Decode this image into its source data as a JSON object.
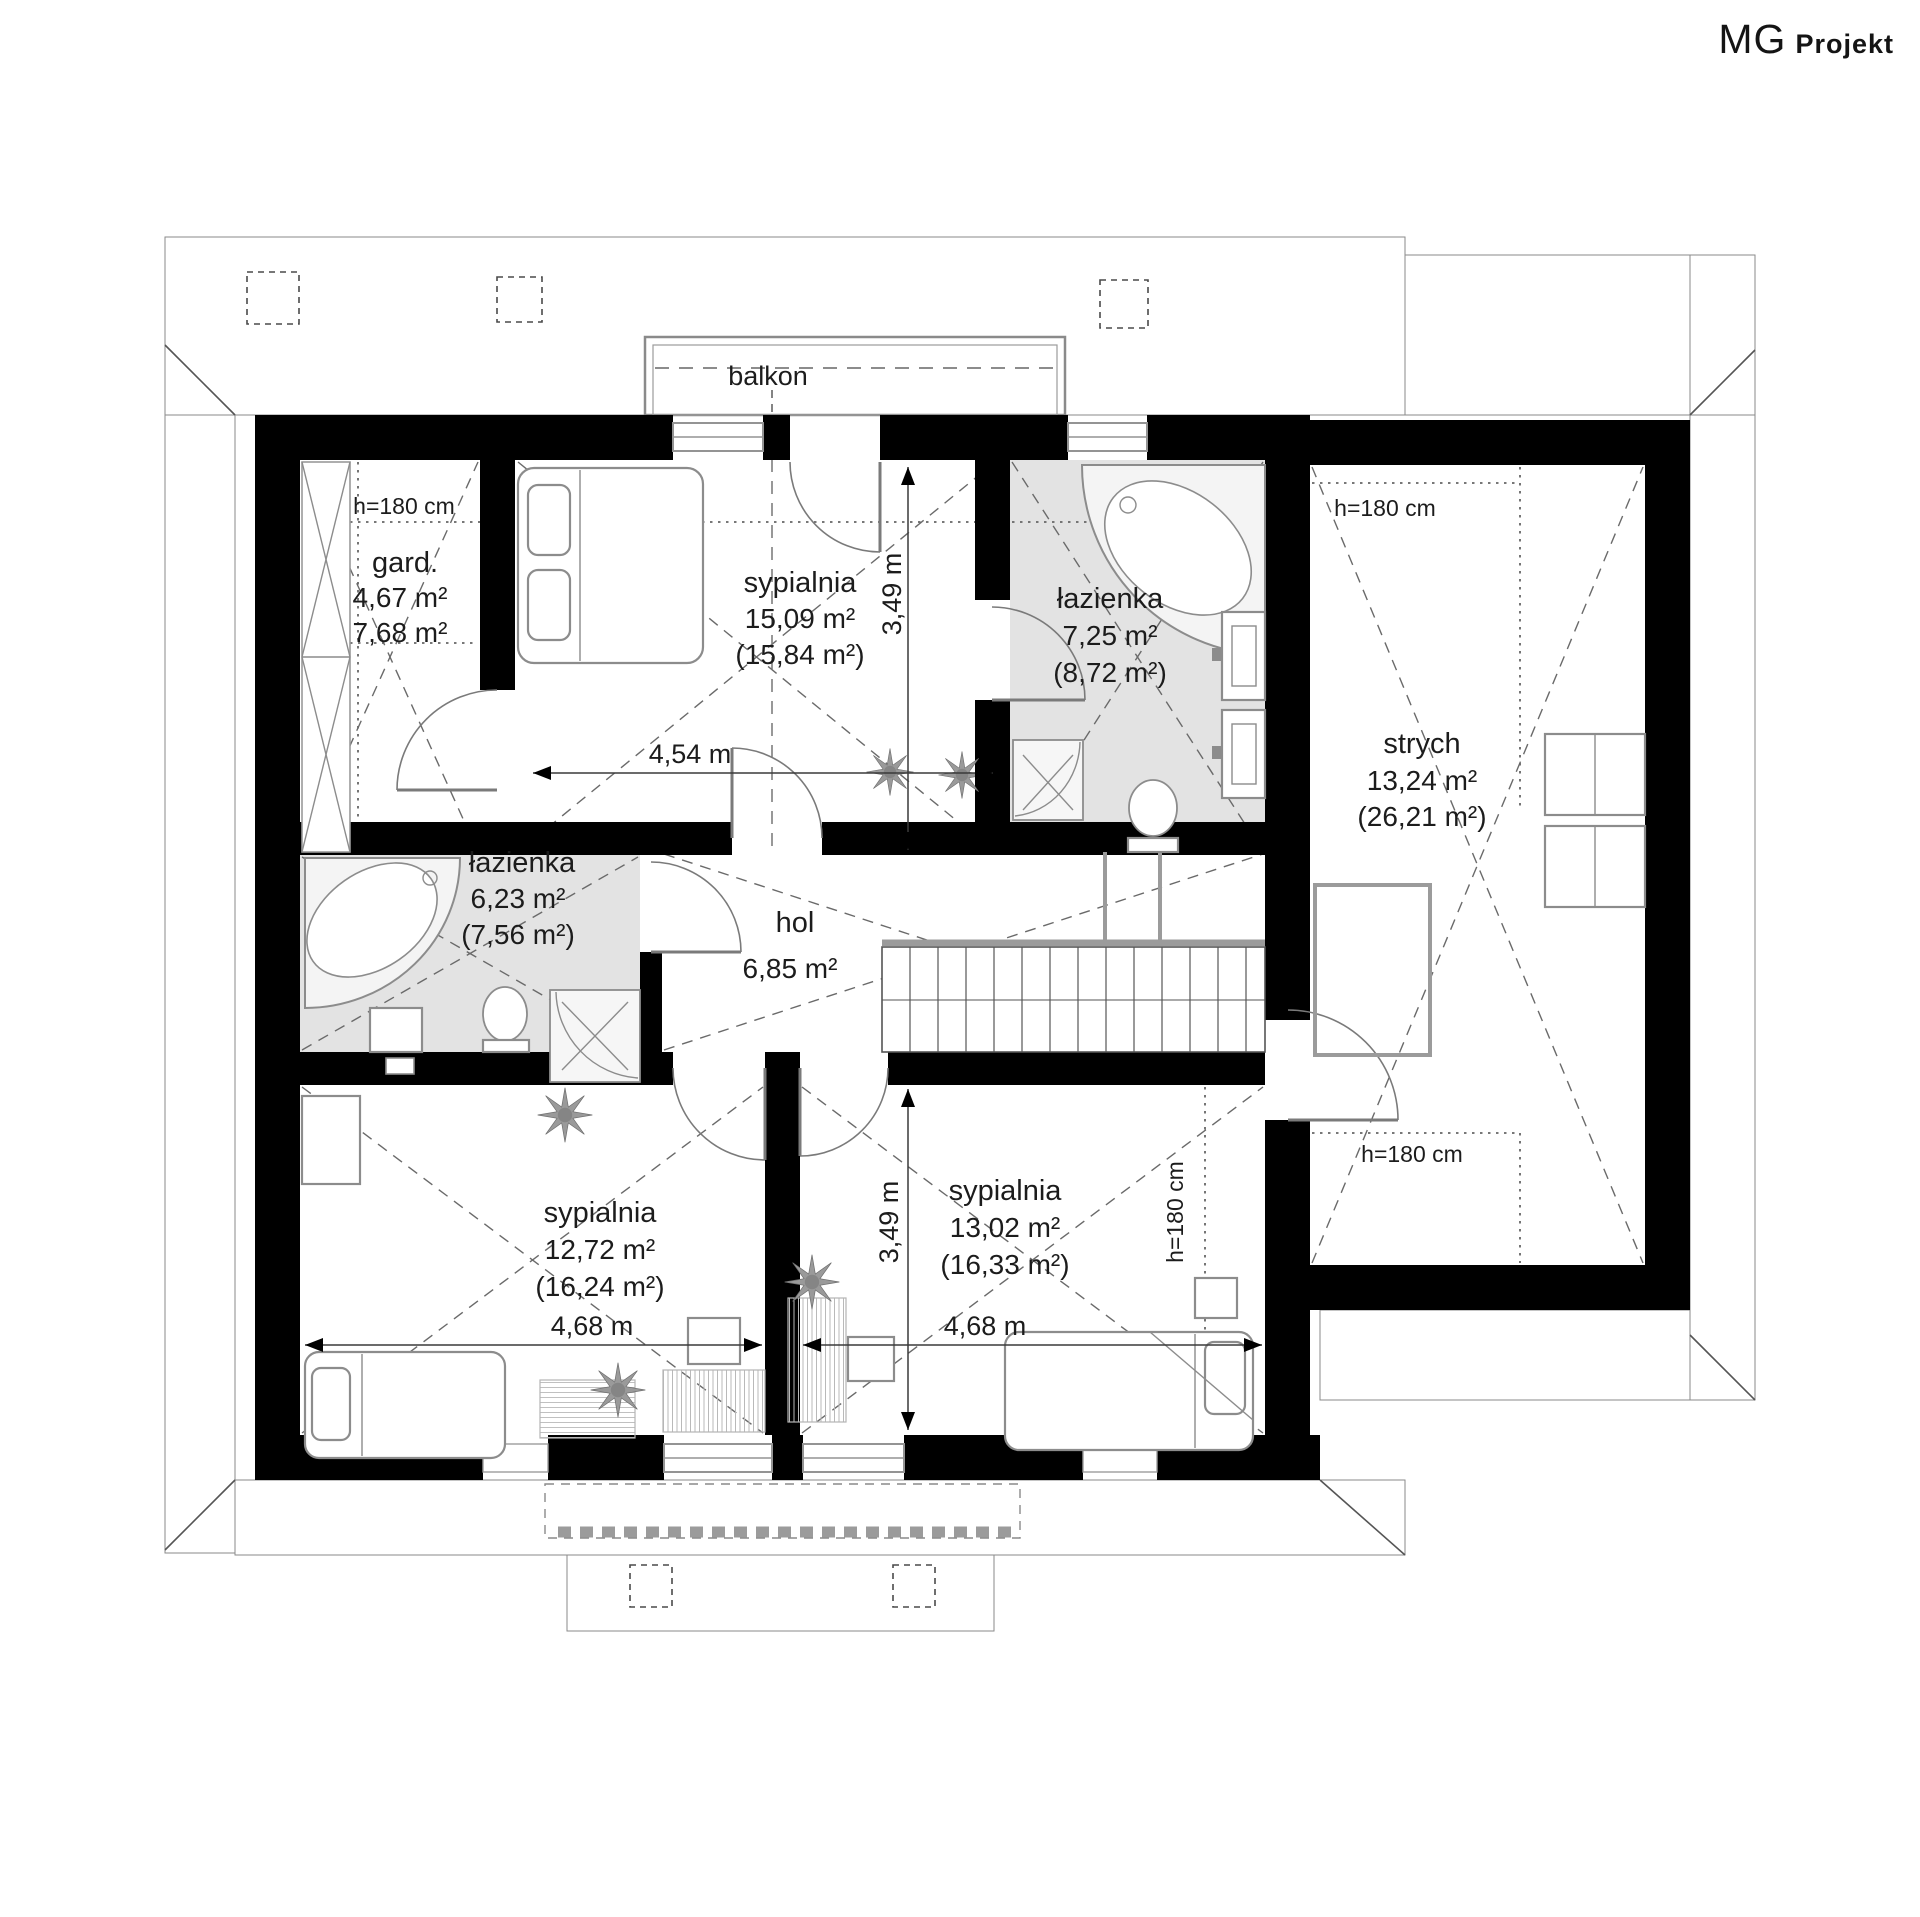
{
  "brand": {
    "mg": "MG",
    "projekt": "Projekt"
  },
  "plan": {
    "balkon": "balkon",
    "rooms": {
      "gard": {
        "name": "gard.",
        "area": "4,67 m²",
        "area2": "7,68 m²"
      },
      "sypialnia_top": {
        "name": "sypialnia",
        "area": "15,09 m²",
        "area2": "(15,84 m²)"
      },
      "lazienka_top": {
        "name": "łazienka",
        "area": "7,25 m²",
        "area2": "(8,72 m²)"
      },
      "strych": {
        "name": "strych",
        "area": "13,24 m²",
        "area2": "(26,21 m²)"
      },
      "lazienka_left": {
        "name": "łazienka",
        "area": "6,23 m²",
        "area2": "(7,56 m²)"
      },
      "hol": {
        "name": "hol",
        "area": "6,85 m²"
      },
      "sypialnia_bl": {
        "name": "sypialnia",
        "area": "12,72 m²",
        "area2": "(16,24 m²)"
      },
      "sypialnia_br": {
        "name": "sypialnia",
        "area": "13,02 m²",
        "area2": "(16,33 m²)"
      }
    },
    "dims": {
      "top_w": "4,54 m",
      "top_d": "3,49 m",
      "bl_w": "4,68 m",
      "br_w": "4,68 m",
      "b_d": "3,49 m"
    },
    "h_labels": {
      "gard": "h=180 cm",
      "strych_top": "h=180 cm",
      "strych_bottom": "h=180 cm",
      "bedroom_br": "h=180 cm"
    },
    "colors": {
      "wall": "#000000",
      "bathroom_floor": "#e3e3e3",
      "roof_hatch": "#909090",
      "dashed_line": "#666666",
      "furniture_stroke": "#8c8c8c",
      "plant": "#9a9a9a"
    }
  }
}
